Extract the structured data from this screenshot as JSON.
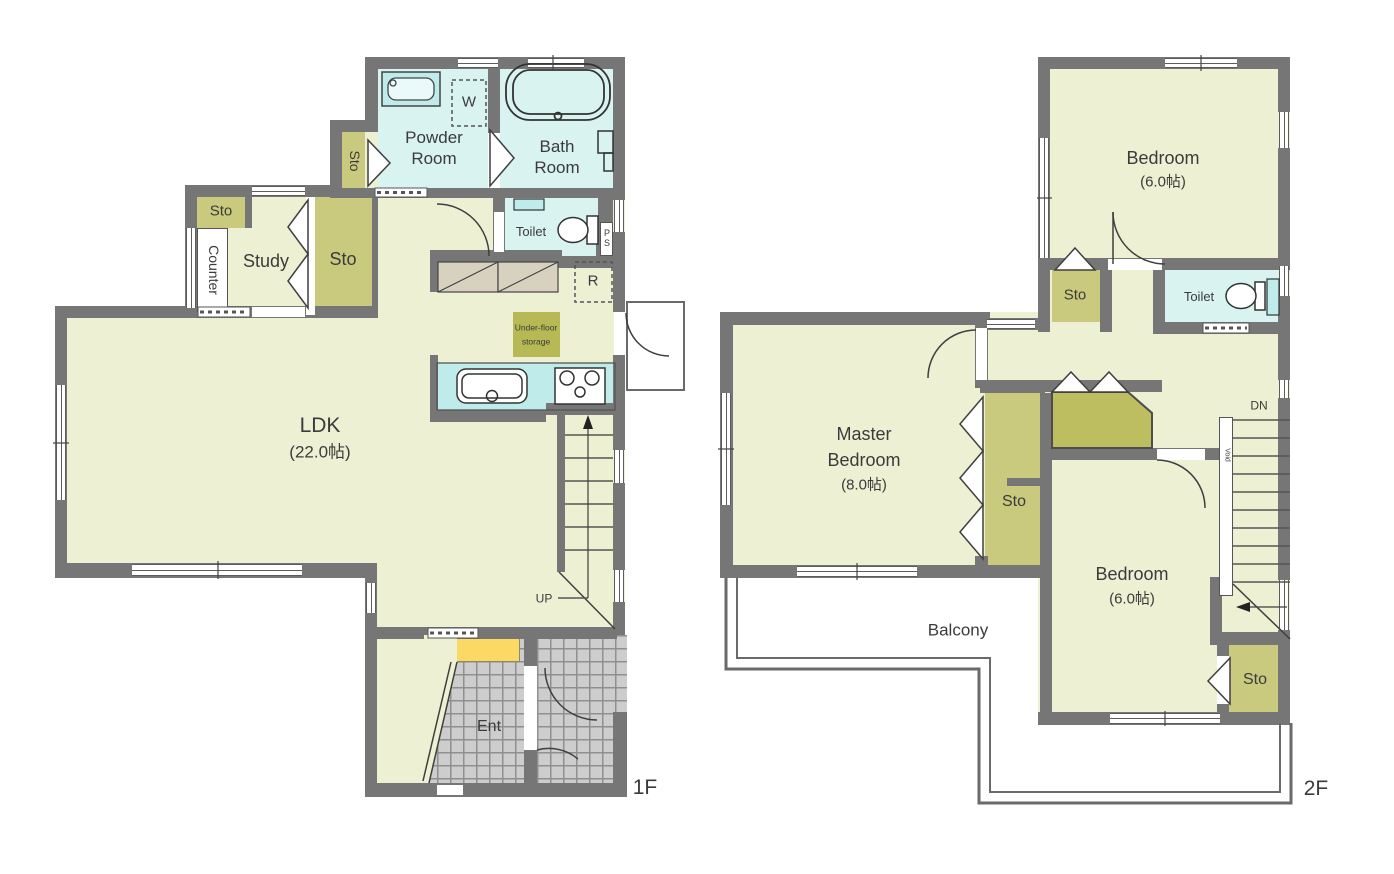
{
  "colors": {
    "wall": "#767676",
    "floor": "#eef0d3",
    "storage": "#c9ca7d",
    "storage_dark": "#b7b955",
    "water": "#d9f3f1",
    "fixture": "#bfeceb",
    "tile": "#cdcdcd",
    "cabinet": "#fbd964"
  },
  "f1": {
    "label": "1F",
    "ldk": "LDK",
    "ldk_size": "(22.0帖)",
    "study": "Study",
    "counter": "Counter",
    "sto_counter": "Sto",
    "sto_study": "Sto",
    "sto_powder": "Sto",
    "powder": "Powder Room",
    "bath": "Bath Room",
    "toilet": "Toilet",
    "washer": "W",
    "fridge": "R",
    "ps": "PS",
    "underfloor1": "Under-floor",
    "underfloor2": "storage",
    "up": "UP",
    "ent": "Ent"
  },
  "f2": {
    "label": "2F",
    "bedroom1": "Bedroom",
    "bedroom1_size": "(6.0帖)",
    "master1": "Master",
    "master2": "Bedroom",
    "master_size": "(8.0帖)",
    "bedroom2": "Bedroom",
    "bedroom2_size": "(6.0帖)",
    "toilet": "Toilet",
    "sto_hall": "Sto",
    "sto_mid": "Sto",
    "sto_low": "Sto",
    "balcony": "Balcony",
    "dn": "DN",
    "void": "Void"
  }
}
